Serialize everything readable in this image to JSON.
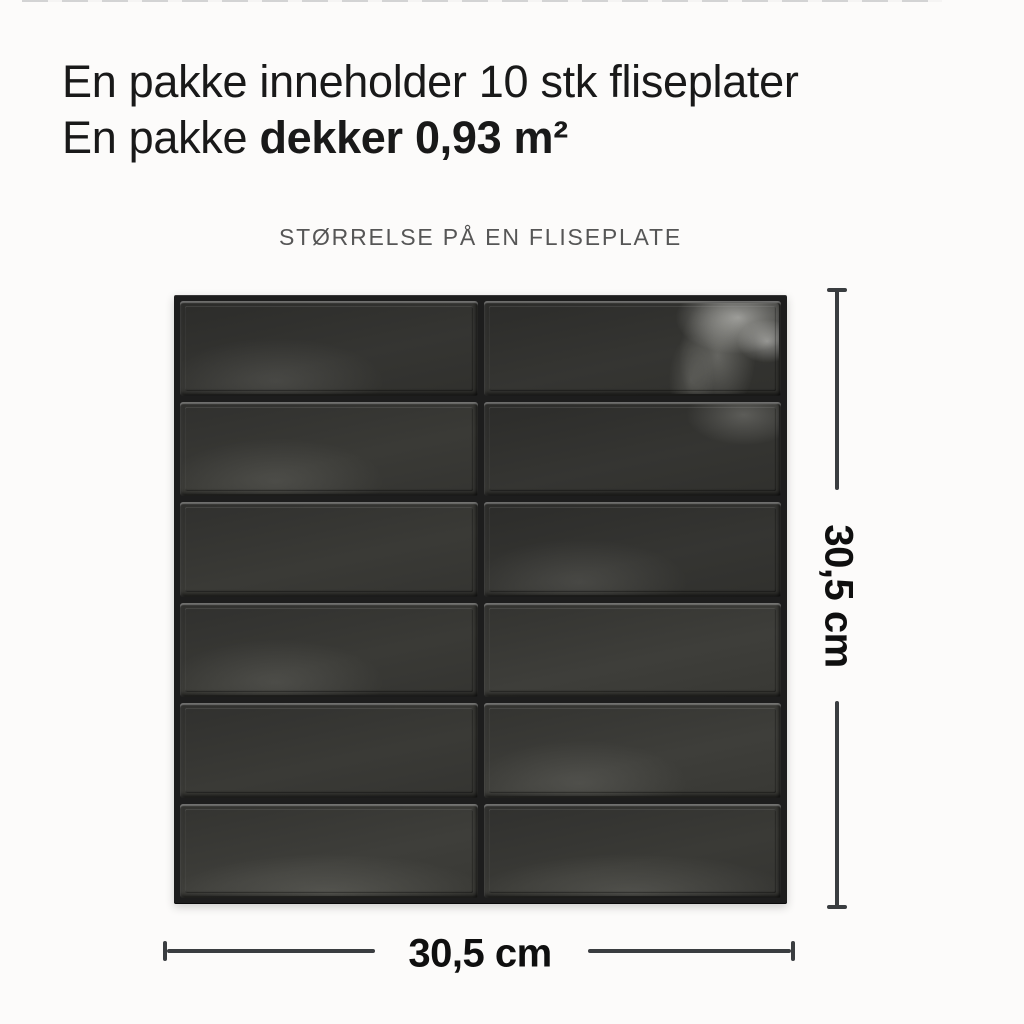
{
  "header": {
    "line1": "En pakke inneholder 10 stk fliseplater",
    "line2_regular": "En pakke ",
    "line2_bold": "dekker 0,93 m²"
  },
  "subtitle": "STØRRELSE PÅ EN FLISEPLATE",
  "panel": {
    "rows": 6,
    "columns": 2,
    "tile_base_color": "#343431",
    "grout_color": "#1d1d1d",
    "tiles": [
      {
        "row": 1,
        "col": 1,
        "tone": "a",
        "sheen": "soft"
      },
      {
        "row": 1,
        "col": 2,
        "tone": "a",
        "sheen": "strong"
      },
      {
        "row": 2,
        "col": 1,
        "tone": "b",
        "sheen": "soft"
      },
      {
        "row": 2,
        "col": 2,
        "tone": "a",
        "sheen": "topright"
      },
      {
        "row": 3,
        "col": 1,
        "tone": "b",
        "sheen": "none"
      },
      {
        "row": 3,
        "col": 2,
        "tone": "a",
        "sheen": "soft"
      },
      {
        "row": 4,
        "col": 1,
        "tone": "b",
        "sheen": "soft"
      },
      {
        "row": 4,
        "col": 2,
        "tone": "c",
        "sheen": "none"
      },
      {
        "row": 5,
        "col": 1,
        "tone": "b",
        "sheen": "none"
      },
      {
        "row": 5,
        "col": 2,
        "tone": "c",
        "sheen": "soft"
      },
      {
        "row": 6,
        "col": 1,
        "tone": "c",
        "sheen": "bottom"
      },
      {
        "row": 6,
        "col": 2,
        "tone": "b",
        "sheen": "bottom"
      }
    ]
  },
  "dimensions": {
    "height_label": "30,5 cm",
    "width_label": "30,5 cm",
    "line_color": "#3a3d40"
  }
}
